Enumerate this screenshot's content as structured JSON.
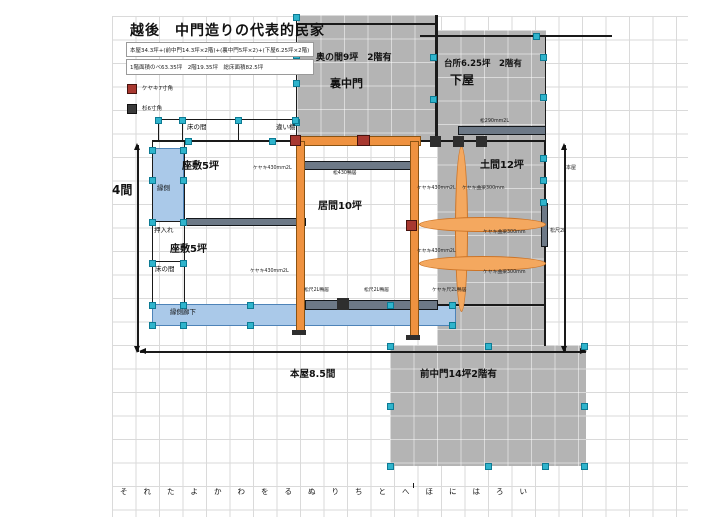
{
  "title": "越後　中門造りの代表的民家",
  "notes": {
    "line1": "本屋34.3坪+(前中門14.3坪×2階)+(裏中門5坪×2)+(下屋6.25坪×2階)",
    "line2": "1階面積のべ63.35坪　2階19.35坪　総床面積82.5坪"
  },
  "legend": {
    "keyaki": {
      "label": "ケヤキ7寸角",
      "color": "#a83830"
    },
    "sugi": {
      "label": "杉6寸角",
      "color": "#3a3a3a"
    }
  },
  "rooms": {
    "okunoma": "奥の間9坪　2階有",
    "urachumon": "裏中門",
    "daidokoro": "台所6.25坪　2階有",
    "geya": "下屋",
    "zashiki_upper": "座敷5坪",
    "zashiki_lower": "座敷5坪",
    "ima": "居間10坪",
    "doma": "土間12坪",
    "engawa": "縁側",
    "oshiire": "押入れ",
    "tokonoma_upper": "床の間",
    "chigaidana": "違い棚",
    "tokonoma_lower": "床の間",
    "engawa_roka": "縁側廊下",
    "maechumon": "前中門14坪2階有"
  },
  "dimensions": {
    "width": "本屋8.5間",
    "height": "4間",
    "right_span": "本屋",
    "right_note": "松尺2L"
  },
  "members": {
    "keyaki430": "ケヤキ430mm2L",
    "kyoryo300": "ケヤキ曲梁300mm",
    "matsu430_kamoi": "松430鴨居",
    "matsu290": "松290mm2L",
    "matsu_shaku_kamoi": "松尺2L鴨居",
    "keyaki_shaku_kamoi": "ケヤキ尺2L鴨居"
  },
  "ruler": {
    "labels": [
      "そ",
      "れ",
      "た",
      "よ",
      "か",
      "わ",
      "を",
      "る",
      "ぬ",
      "り",
      "ち",
      "と",
      "へ",
      "ほ",
      "に",
      "は",
      "ろ",
      "い"
    ]
  },
  "colors": {
    "gray_fill": "#b4b4b4",
    "blue_fill": "#aac9e9",
    "orange": "#ef9240",
    "slate_beam": "#6d7987",
    "handle": "#2fb4cc",
    "red_joint": "#a83830"
  }
}
